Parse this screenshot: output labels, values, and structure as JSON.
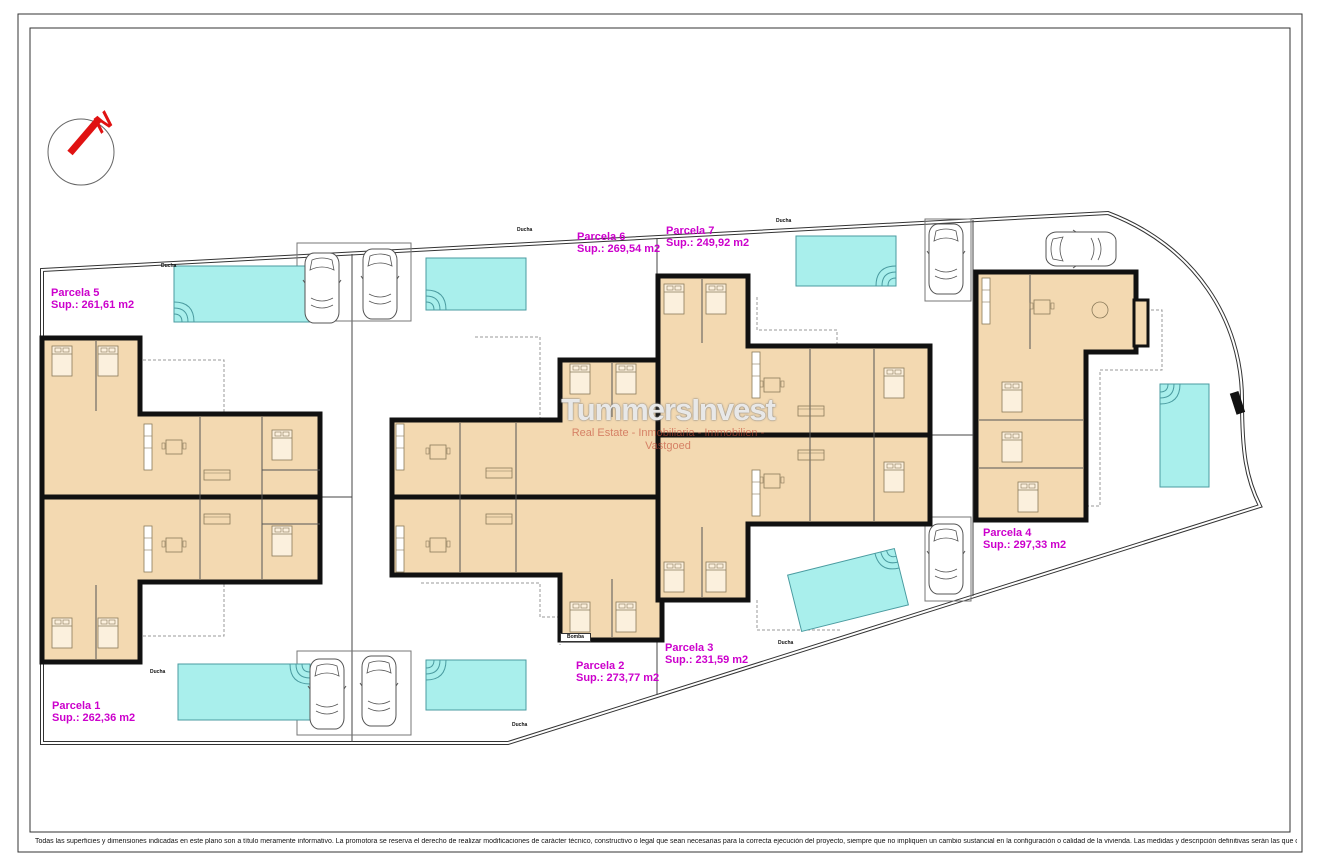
{
  "plan": {
    "compass_letter": "N",
    "watermark": {
      "title": "TummersInvest",
      "subtitle": "Real Estate - Inmobiliaria - Immobilien - Vastgoed"
    },
    "parcels": [
      {
        "name": "Parcela 1",
        "area": "Sup.: 262,36 m2"
      },
      {
        "name": "Parcela 2",
        "area": "Sup.: 273,77 m2"
      },
      {
        "name": "Parcela 3",
        "area": "Sup.: 231,59 m2"
      },
      {
        "name": "Parcela 4",
        "area": "Sup.: 297,33 m2"
      },
      {
        "name": "Parcela 5",
        "area": "Sup.: 261,61 m2"
      },
      {
        "name": "Parcela 6",
        "area": "Sup.: 269,54 m2"
      },
      {
        "name": "Parcela 7",
        "area": "Sup.: 249,92 m2"
      }
    ],
    "small_labels": [
      "Ducha",
      "Ducha",
      "Ducha",
      "Ducha",
      "Ducha",
      "Ducha",
      "Bomba"
    ],
    "disclaimer": "Todas las superficies y dimensiones indicadas en este plano son a título meramente informativo. La promotora se reserva el derecho de realizar modificaciones de carácter técnico, constructivo o legal que sean necesarias para la correcta ejecución del proyecto, siempre que no impliquen un cambio sustancial en la configuración o calidad de la vivienda. Las medidas y descripción definitivas serán las que constan en la Escritura Pública de Obra Nueva y División Horizontal. Los elementos de mobiliario y decoración son ilustrativos y no serán incluidos.",
    "colors": {
      "parcel_label": "#cc00cc",
      "pool": "#a9efec",
      "floor": "#f3d9b1",
      "wall": "#111111",
      "compass_red": "#e01212"
    }
  }
}
